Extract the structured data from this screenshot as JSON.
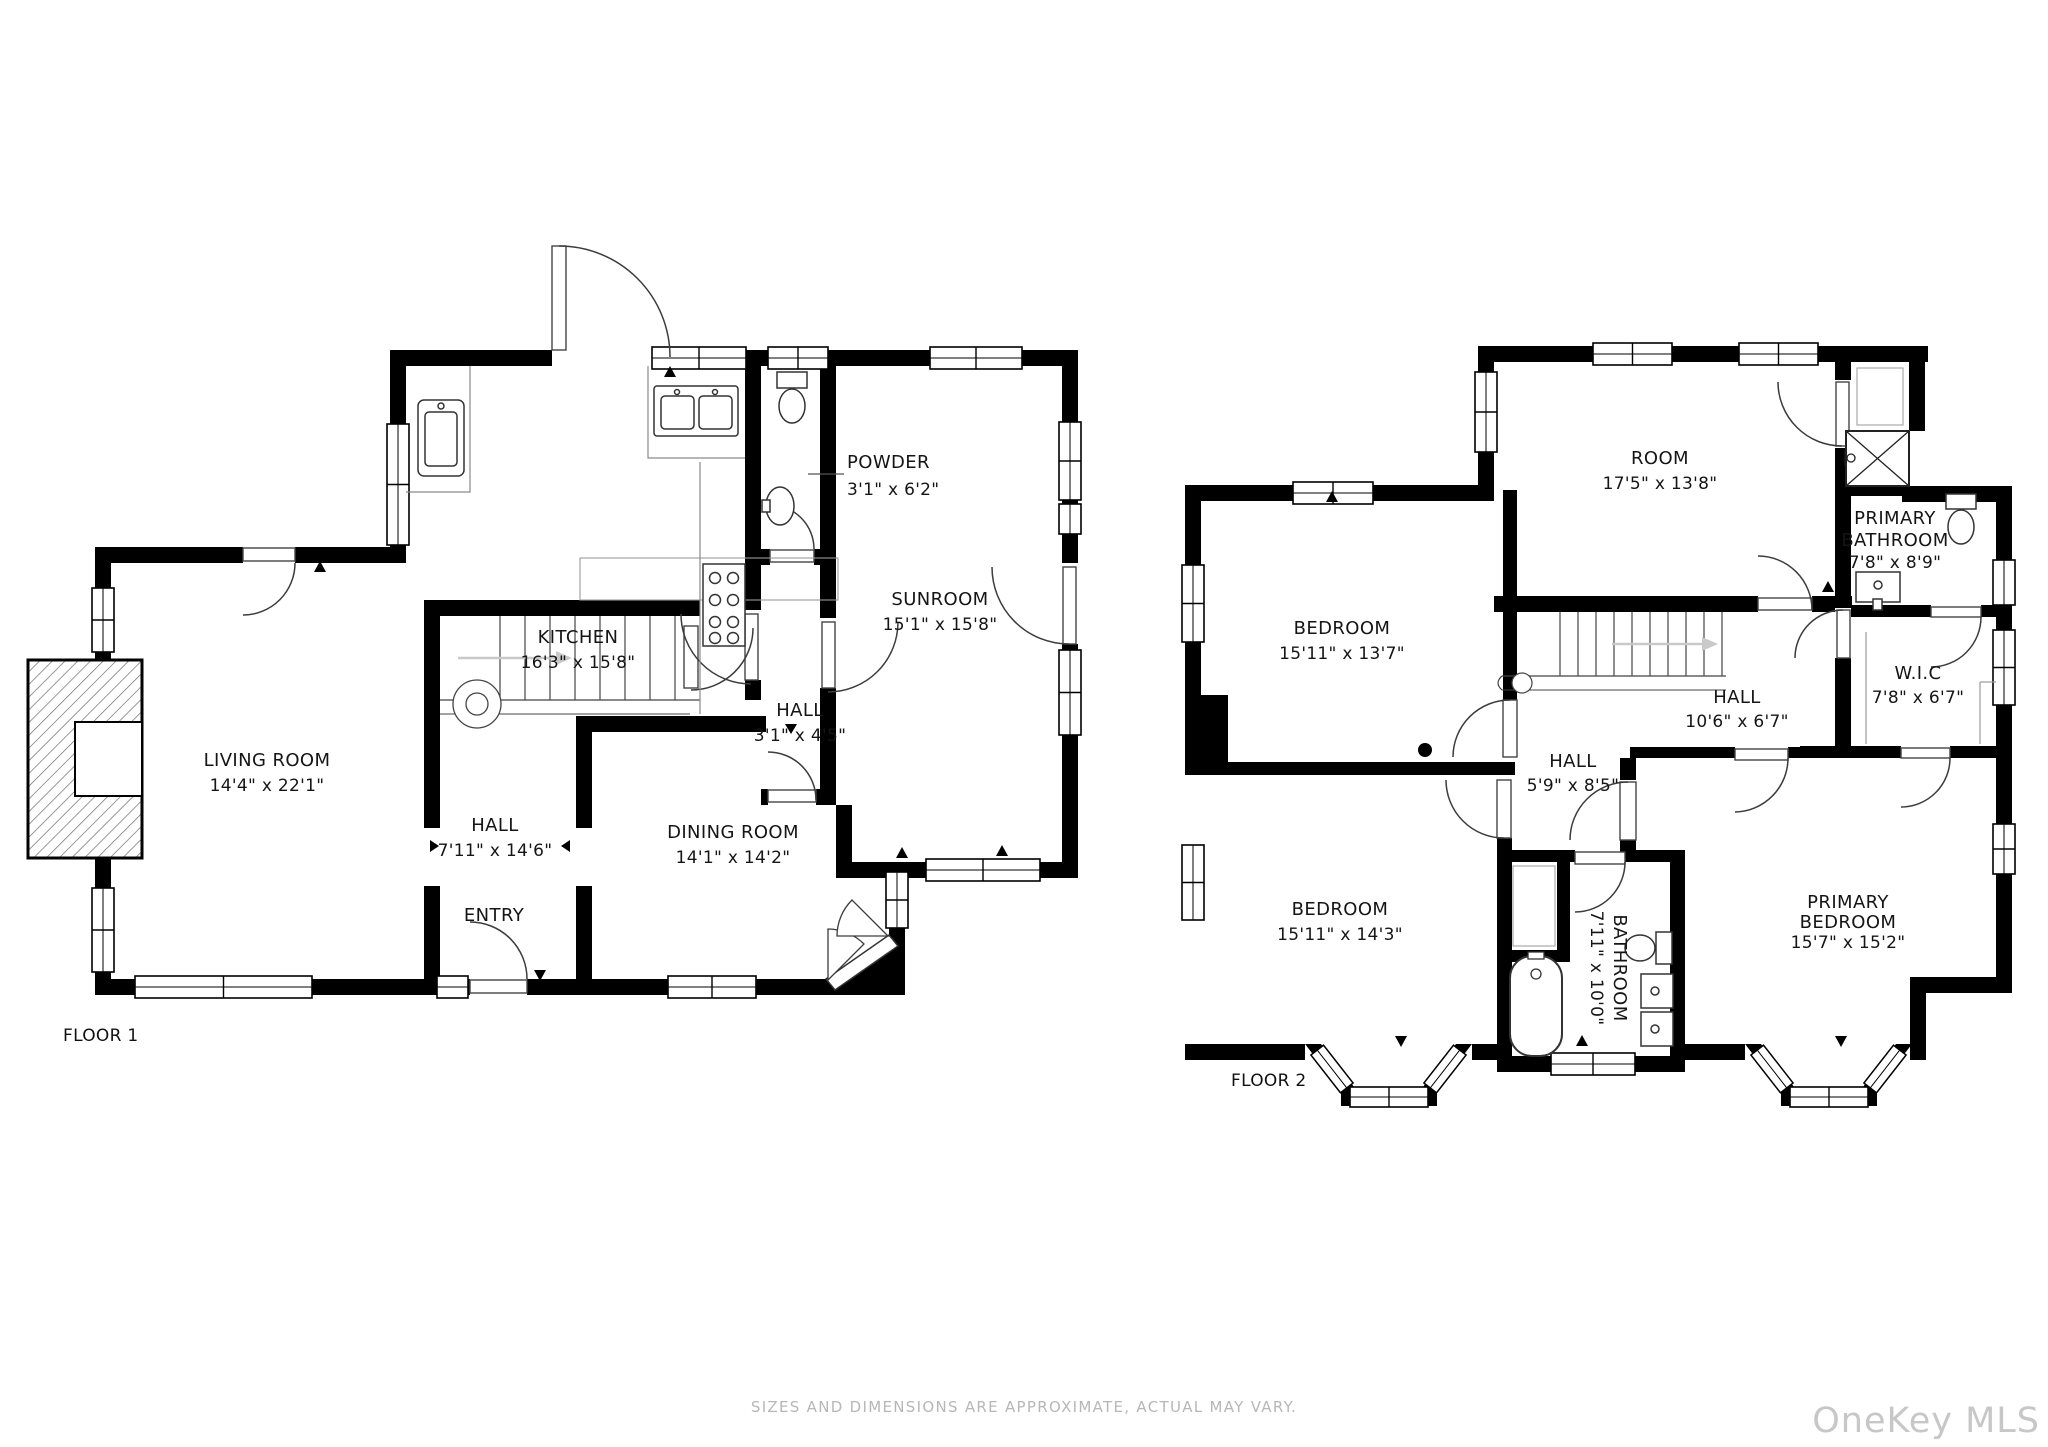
{
  "page": {
    "background": "#ffffff"
  },
  "floor1": {
    "label": "FLOOR 1",
    "rooms": {
      "living": {
        "name": "LIVING ROOM",
        "dims": "14'4\" x 22'1\""
      },
      "kitchen": {
        "name": "KITCHEN",
        "dims": "16'3\" x 15'8\""
      },
      "powder": {
        "name": "POWDER",
        "dims": "3'1\" x 6'2\""
      },
      "sunroom": {
        "name": "SUNROOM",
        "dims": "15'1\" x 15'8\""
      },
      "hall_small": {
        "name": "HALL",
        "dims": "3'1\" x 4'5\""
      },
      "hall": {
        "name": "HALL",
        "dims": "7'11\" x 14'6\""
      },
      "entry": {
        "name": "ENTRY"
      },
      "dining": {
        "name": "DINING ROOM",
        "dims": "14'1\" x 14'2\""
      }
    }
  },
  "floor2": {
    "label": "FLOOR 2",
    "rooms": {
      "room": {
        "name": "ROOM",
        "dims": "17'5\" x 13'8\""
      },
      "primary_bathroom": {
        "name1": "PRIMARY",
        "name2": "BATHROOM",
        "dims": "7'8\" x 8'9\""
      },
      "bedroom_upper": {
        "name": "BEDROOM",
        "dims": "15'11\" x 13'7\""
      },
      "hall_upper": {
        "name": "HALL",
        "dims": "10'6\" x 6'7\""
      },
      "wic": {
        "name": "W.I.C",
        "dims": "7'8\" x 6'7\""
      },
      "hall_lower": {
        "name": "HALL",
        "dims": "5'9\" x 8'5\""
      },
      "bedroom_lower": {
        "name": "BEDROOM",
        "dims": "15'11\" x 14'3\""
      },
      "bathroom": {
        "name": "BATHROOM",
        "dims": "7'11\" x 10'0\""
      },
      "primary_bedroom": {
        "name1": "PRIMARY",
        "name2": "BEDROOM",
        "dims": "15'7\" x 15'2\""
      }
    }
  },
  "footer": {
    "disclaimer": "SIZES AND DIMENSIONS ARE APPROXIMATE, ACTUAL MAY VARY.",
    "watermark": "OneKey MLS"
  },
  "colors": {
    "wall": "#000000",
    "label": "#151515",
    "muted": "#b7b7b7",
    "watermark": "#c7c7c7"
  }
}
